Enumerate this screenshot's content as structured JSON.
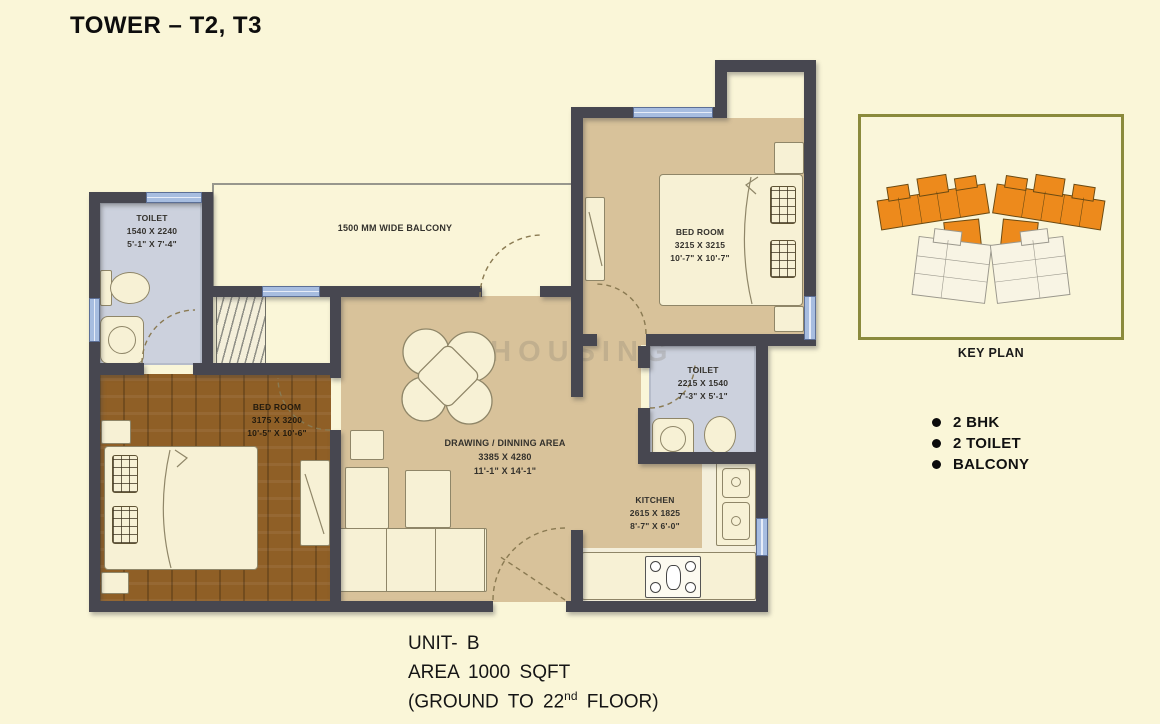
{
  "header": {
    "title": "TOWER – T2, T3"
  },
  "watermark": {
    "text": "HOUSING"
  },
  "rooms": {
    "toilet1": {
      "name": "TOILET",
      "mm": "1540 X 2240",
      "ft": "5'-1\" X 7'-4\""
    },
    "balcony": {
      "name": "1500 MM  WIDE BALCONY"
    },
    "bedroom2": {
      "name": "BED ROOM",
      "mm": "3215 X 3215",
      "ft": "10'-7\" X 10'-7\""
    },
    "bedroom1": {
      "name": "BED ROOM",
      "mm": "3175 X 3200",
      "ft": "10'-5\" X 10'-6\""
    },
    "hall": {
      "name": "DRAWING / DINNING AREA",
      "mm": "3385 X 4280",
      "ft": "11'-1\" X 14'-1\""
    },
    "toilet2": {
      "name": "TOILET",
      "mm": "2215 X 1540",
      "ft": "7'-3\" X 5'-1\""
    },
    "kitchen": {
      "name": "KITCHEN",
      "mm": "2615 X 1825",
      "ft": "8'-7\" X 6'-0\""
    }
  },
  "key_plan": {
    "label": "KEY PLAN"
  },
  "legend": {
    "items": [
      "2 BHK",
      "2 TOILET",
      "BALCONY"
    ]
  },
  "footer": {
    "unit": "UNIT- B",
    "area": "AREA  1000 SQFT",
    "floors_prefix": "(GROUND  TO 22",
    "floors_sup": "nd",
    "floors_suffix": " FLOOR)"
  },
  "colors": {
    "background": "#FAF6D8",
    "wall": "#474750",
    "floor_tan": "#D8C29A",
    "floor_wood": "#8F5F26",
    "floor_toilet": "#CCD1DD",
    "window_blue": "#A7BDE0",
    "furniture": "#F7F1D5",
    "keyplan_orange": "#ED8A1C",
    "keyplan_border": "#8A8A3C"
  }
}
